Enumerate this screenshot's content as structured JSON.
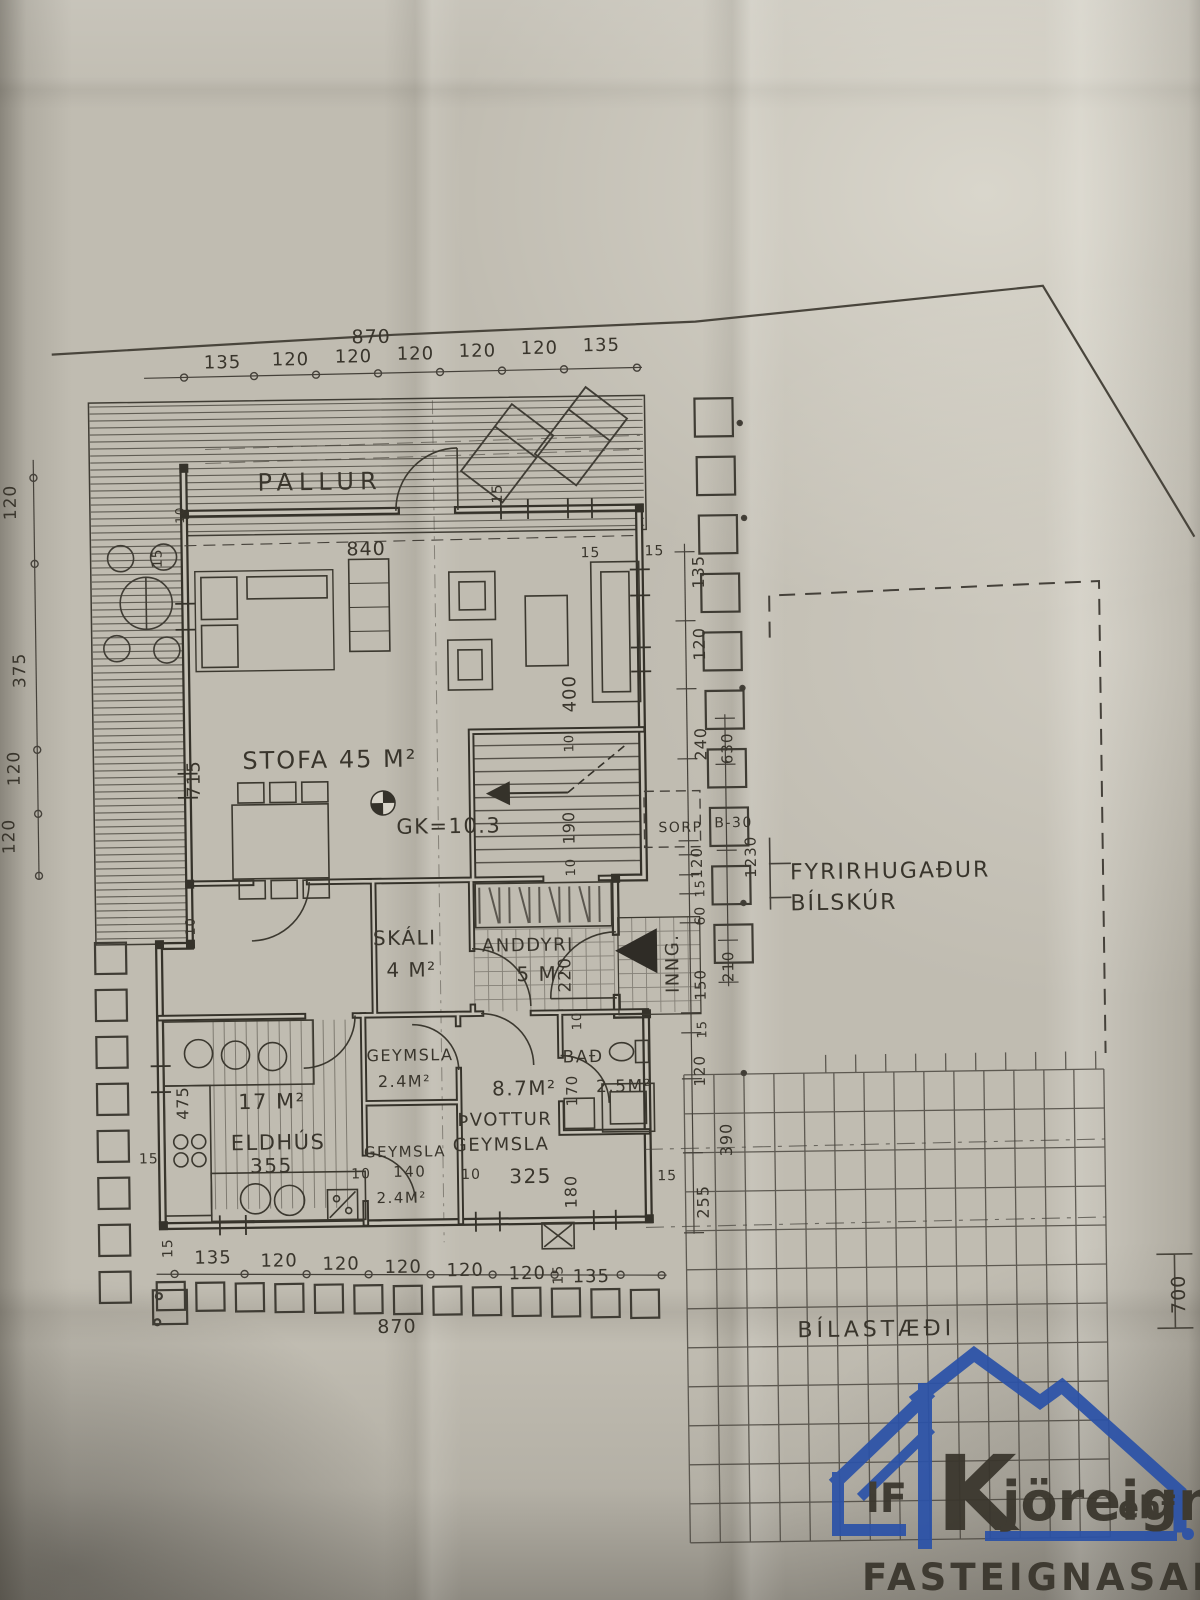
{
  "plan": {
    "room_labels": [
      {
        "t": "PALLUR",
        "x": 262,
        "y": 486,
        "s": 24,
        "ls": 6
      },
      {
        "t": "STOFA 45 M²",
        "x": 243,
        "y": 764,
        "s": 24,
        "ls": 2
      },
      {
        "t": "GK=10.3",
        "x": 396,
        "y": 831,
        "s": 21
      },
      {
        "t": "SKÁLI",
        "x": 371,
        "y": 942,
        "s": 20
      },
      {
        "t": "4 M²",
        "x": 384,
        "y": 974,
        "s": 20
      },
      {
        "t": "ANDDYRI",
        "x": 480,
        "y": 950,
        "s": 18
      },
      {
        "t": "5 M²",
        "x": 514,
        "y": 980,
        "s": 20
      },
      {
        "t": "GEYMSLA",
        "x": 363,
        "y": 1058,
        "s": 16
      },
      {
        "t": "2.4M²",
        "x": 374,
        "y": 1084,
        "s": 16
      },
      {
        "t": "8.7M²",
        "x": 488,
        "y": 1094,
        "s": 20
      },
      {
        "t": "BAÐ",
        "x": 559,
        "y": 1062,
        "s": 17
      },
      {
        "t": "2.5M²",
        "x": 592,
        "y": 1092,
        "s": 17
      },
      {
        "t": "ÞVOTTUR",
        "x": 453,
        "y": 1124,
        "s": 18
      },
      {
        "t": "GEYMSLA",
        "x": 448,
        "y": 1149,
        "s": 18
      },
      {
        "t": "325",
        "x": 504,
        "y": 1182,
        "s": 20
      },
      {
        "t": "GEYMSLA",
        "x": 359,
        "y": 1154,
        "s": 15
      },
      {
        "t": "140",
        "x": 388,
        "y": 1174,
        "s": 15
      },
      {
        "t": "2.4M²",
        "x": 371,
        "y": 1200,
        "s": 15
      },
      {
        "t": "17 M²",
        "x": 234,
        "y": 1104,
        "s": 21
      },
      {
        "t": "ELDHÚS",
        "x": 226,
        "y": 1145,
        "s": 21
      },
      {
        "t": "355",
        "x": 245,
        "y": 1168,
        "s": 20
      },
      {
        "t": "SORP",
        "x": 658,
        "y": 833,
        "s": 14
      },
      {
        "t": "B-30",
        "x": 714,
        "y": 829,
        "s": 14
      },
      {
        "t": "INNG.",
        "x": 676,
        "y": 994,
        "s": 18,
        "r": -90
      },
      {
        "t": "FYRIRHUGAÐUR",
        "x": 789,
        "y": 882,
        "s": 22,
        "ls": 2
      },
      {
        "t": "BÍLSKÚR",
        "x": 789,
        "y": 913,
        "s": 22,
        "ls": 2
      },
      {
        "t": "BÍLASTÆÐI",
        "x": 790,
        "y": 1340,
        "s": 22,
        "ls": 4
      }
    ],
    "dim_labels": [
      {
        "t": "870",
        "x": 358,
        "y": 340,
        "s": 19
      },
      {
        "t": "135",
        "x": 210,
        "y": 363,
        "s": 18
      },
      {
        "t": "120",
        "x": 278,
        "y": 361,
        "s": 18
      },
      {
        "t": "120",
        "x": 341,
        "y": 359,
        "s": 18
      },
      {
        "t": "120",
        "x": 403,
        "y": 357,
        "s": 18
      },
      {
        "t": "120",
        "x": 465,
        "y": 355,
        "s": 18
      },
      {
        "t": "120",
        "x": 527,
        "y": 353,
        "s": 18
      },
      {
        "t": "135",
        "x": 589,
        "y": 351,
        "s": 18
      },
      {
        "t": "840",
        "x": 350,
        "y": 552,
        "s": 19
      },
      {
        "t": "15",
        "x": 584,
        "y": 557,
        "s": 14
      },
      {
        "t": "15",
        "x": 648,
        "y": 556,
        "s": 14
      },
      {
        "t": "15",
        "x": 506,
        "y": 502,
        "s": 14,
        "r": -90
      },
      {
        "t": "15",
        "x": 165,
        "y": 562,
        "s": 14,
        "r": -90
      },
      {
        "t": "10",
        "x": 188,
        "y": 518,
        "s": 12,
        "r": -90
      },
      {
        "t": "715",
        "x": 200,
        "y": 792,
        "s": 18,
        "r": -90
      },
      {
        "t": "475",
        "x": 184,
        "y": 1114,
        "s": 16,
        "r": -90
      },
      {
        "t": "10",
        "x": 193,
        "y": 930,
        "s": 13,
        "r": -90
      },
      {
        "t": "400",
        "x": 577,
        "y": 712,
        "s": 18,
        "r": -90
      },
      {
        "t": "10",
        "x": 574,
        "y": 752,
        "s": 13,
        "r": -90
      },
      {
        "t": "190",
        "x": 574,
        "y": 844,
        "s": 16,
        "r": -90
      },
      {
        "t": "10",
        "x": 574,
        "y": 876,
        "s": 13,
        "r": -90
      },
      {
        "t": "220",
        "x": 568,
        "y": 992,
        "s": 17,
        "r": -90
      },
      {
        "t": "10",
        "x": 578,
        "y": 1030,
        "s": 13,
        "r": -90
      },
      {
        "t": "170",
        "x": 573,
        "y": 1106,
        "s": 15,
        "r": -90
      },
      {
        "t": "180",
        "x": 571,
        "y": 1208,
        "s": 16,
        "r": -90
      },
      {
        "t": "10",
        "x": 346,
        "y": 1175,
        "s": 14
      },
      {
        "t": "10",
        "x": 456,
        "y": 1177,
        "s": 14
      },
      {
        "t": "15",
        "x": 652,
        "y": 1181,
        "s": 14
      },
      {
        "t": "15",
        "x": 134,
        "y": 1157,
        "s": 14
      },
      {
        "t": "15",
        "x": 166,
        "y": 1252,
        "s": 14,
        "r": -90
      },
      {
        "t": "135",
        "x": 188,
        "y": 1258,
        "s": 18
      },
      {
        "t": "120",
        "x": 254,
        "y": 1262,
        "s": 18
      },
      {
        "t": "120",
        "x": 316,
        "y": 1266,
        "s": 18
      },
      {
        "t": "120",
        "x": 378,
        "y": 1270,
        "s": 18
      },
      {
        "t": "120",
        "x": 440,
        "y": 1274,
        "s": 18
      },
      {
        "t": "120",
        "x": 502,
        "y": 1278,
        "s": 18
      },
      {
        "t": "135",
        "x": 566,
        "y": 1282,
        "s": 18
      },
      {
        "t": "870",
        "x": 370,
        "y": 1330,
        "s": 19
      },
      {
        "t": "15",
        "x": 556,
        "y": 1284,
        "s": 14,
        "r": -90
      },
      {
        "t": "120",
        "x": 20,
        "y": 512,
        "s": 17,
        "r": -90
      },
      {
        "t": "375",
        "x": 27,
        "y": 680,
        "s": 17,
        "r": -90
      },
      {
        "t": "120",
        "x": 20,
        "y": 778,
        "s": 17,
        "r": -90
      },
      {
        "t": "120",
        "x": 14,
        "y": 846,
        "s": 17,
        "r": -90
      },
      {
        "t": "135",
        "x": 707,
        "y": 590,
        "s": 16,
        "r": -90
      },
      {
        "t": "120",
        "x": 707,
        "y": 662,
        "s": 16,
        "r": -90
      },
      {
        "t": "240",
        "x": 707,
        "y": 762,
        "s": 16,
        "r": -90
      },
      {
        "t": "630",
        "x": 733,
        "y": 766,
        "s": 15,
        "r": -90
      },
      {
        "t": "1230",
        "x": 755,
        "y": 880,
        "s": 15,
        "r": -90
      },
      {
        "t": "120",
        "x": 701,
        "y": 880,
        "s": 15,
        "r": -90
      },
      {
        "t": "15",
        "x": 703,
        "y": 899,
        "s": 13,
        "r": -90
      },
      {
        "t": "60",
        "x": 703,
        "y": 927,
        "s": 14,
        "r": -90
      },
      {
        "t": "150",
        "x": 703,
        "y": 1002,
        "s": 15,
        "r": -90
      },
      {
        "t": "210",
        "x": 731,
        "y": 984,
        "s": 15,
        "r": -90
      },
      {
        "t": "15",
        "x": 703,
        "y": 1040,
        "s": 13,
        "r": -90
      },
      {
        "t": "120",
        "x": 701,
        "y": 1088,
        "s": 15,
        "r": -90
      },
      {
        "t": "390",
        "x": 727,
        "y": 1158,
        "s": 16,
        "r": -90
      },
      {
        "t": "255",
        "x": 703,
        "y": 1220,
        "s": 16,
        "r": -90
      },
      {
        "t": "700",
        "x": 1178,
        "y": 1322,
        "s": 19,
        "r": -90
      }
    ]
  },
  "logo": {
    "prefix": "lF",
    "k": "K",
    "name": "jöreign",
    "suffix": "ehf",
    "subtitle": "FASTEIGNASALA",
    "color": "#2b52a8"
  }
}
